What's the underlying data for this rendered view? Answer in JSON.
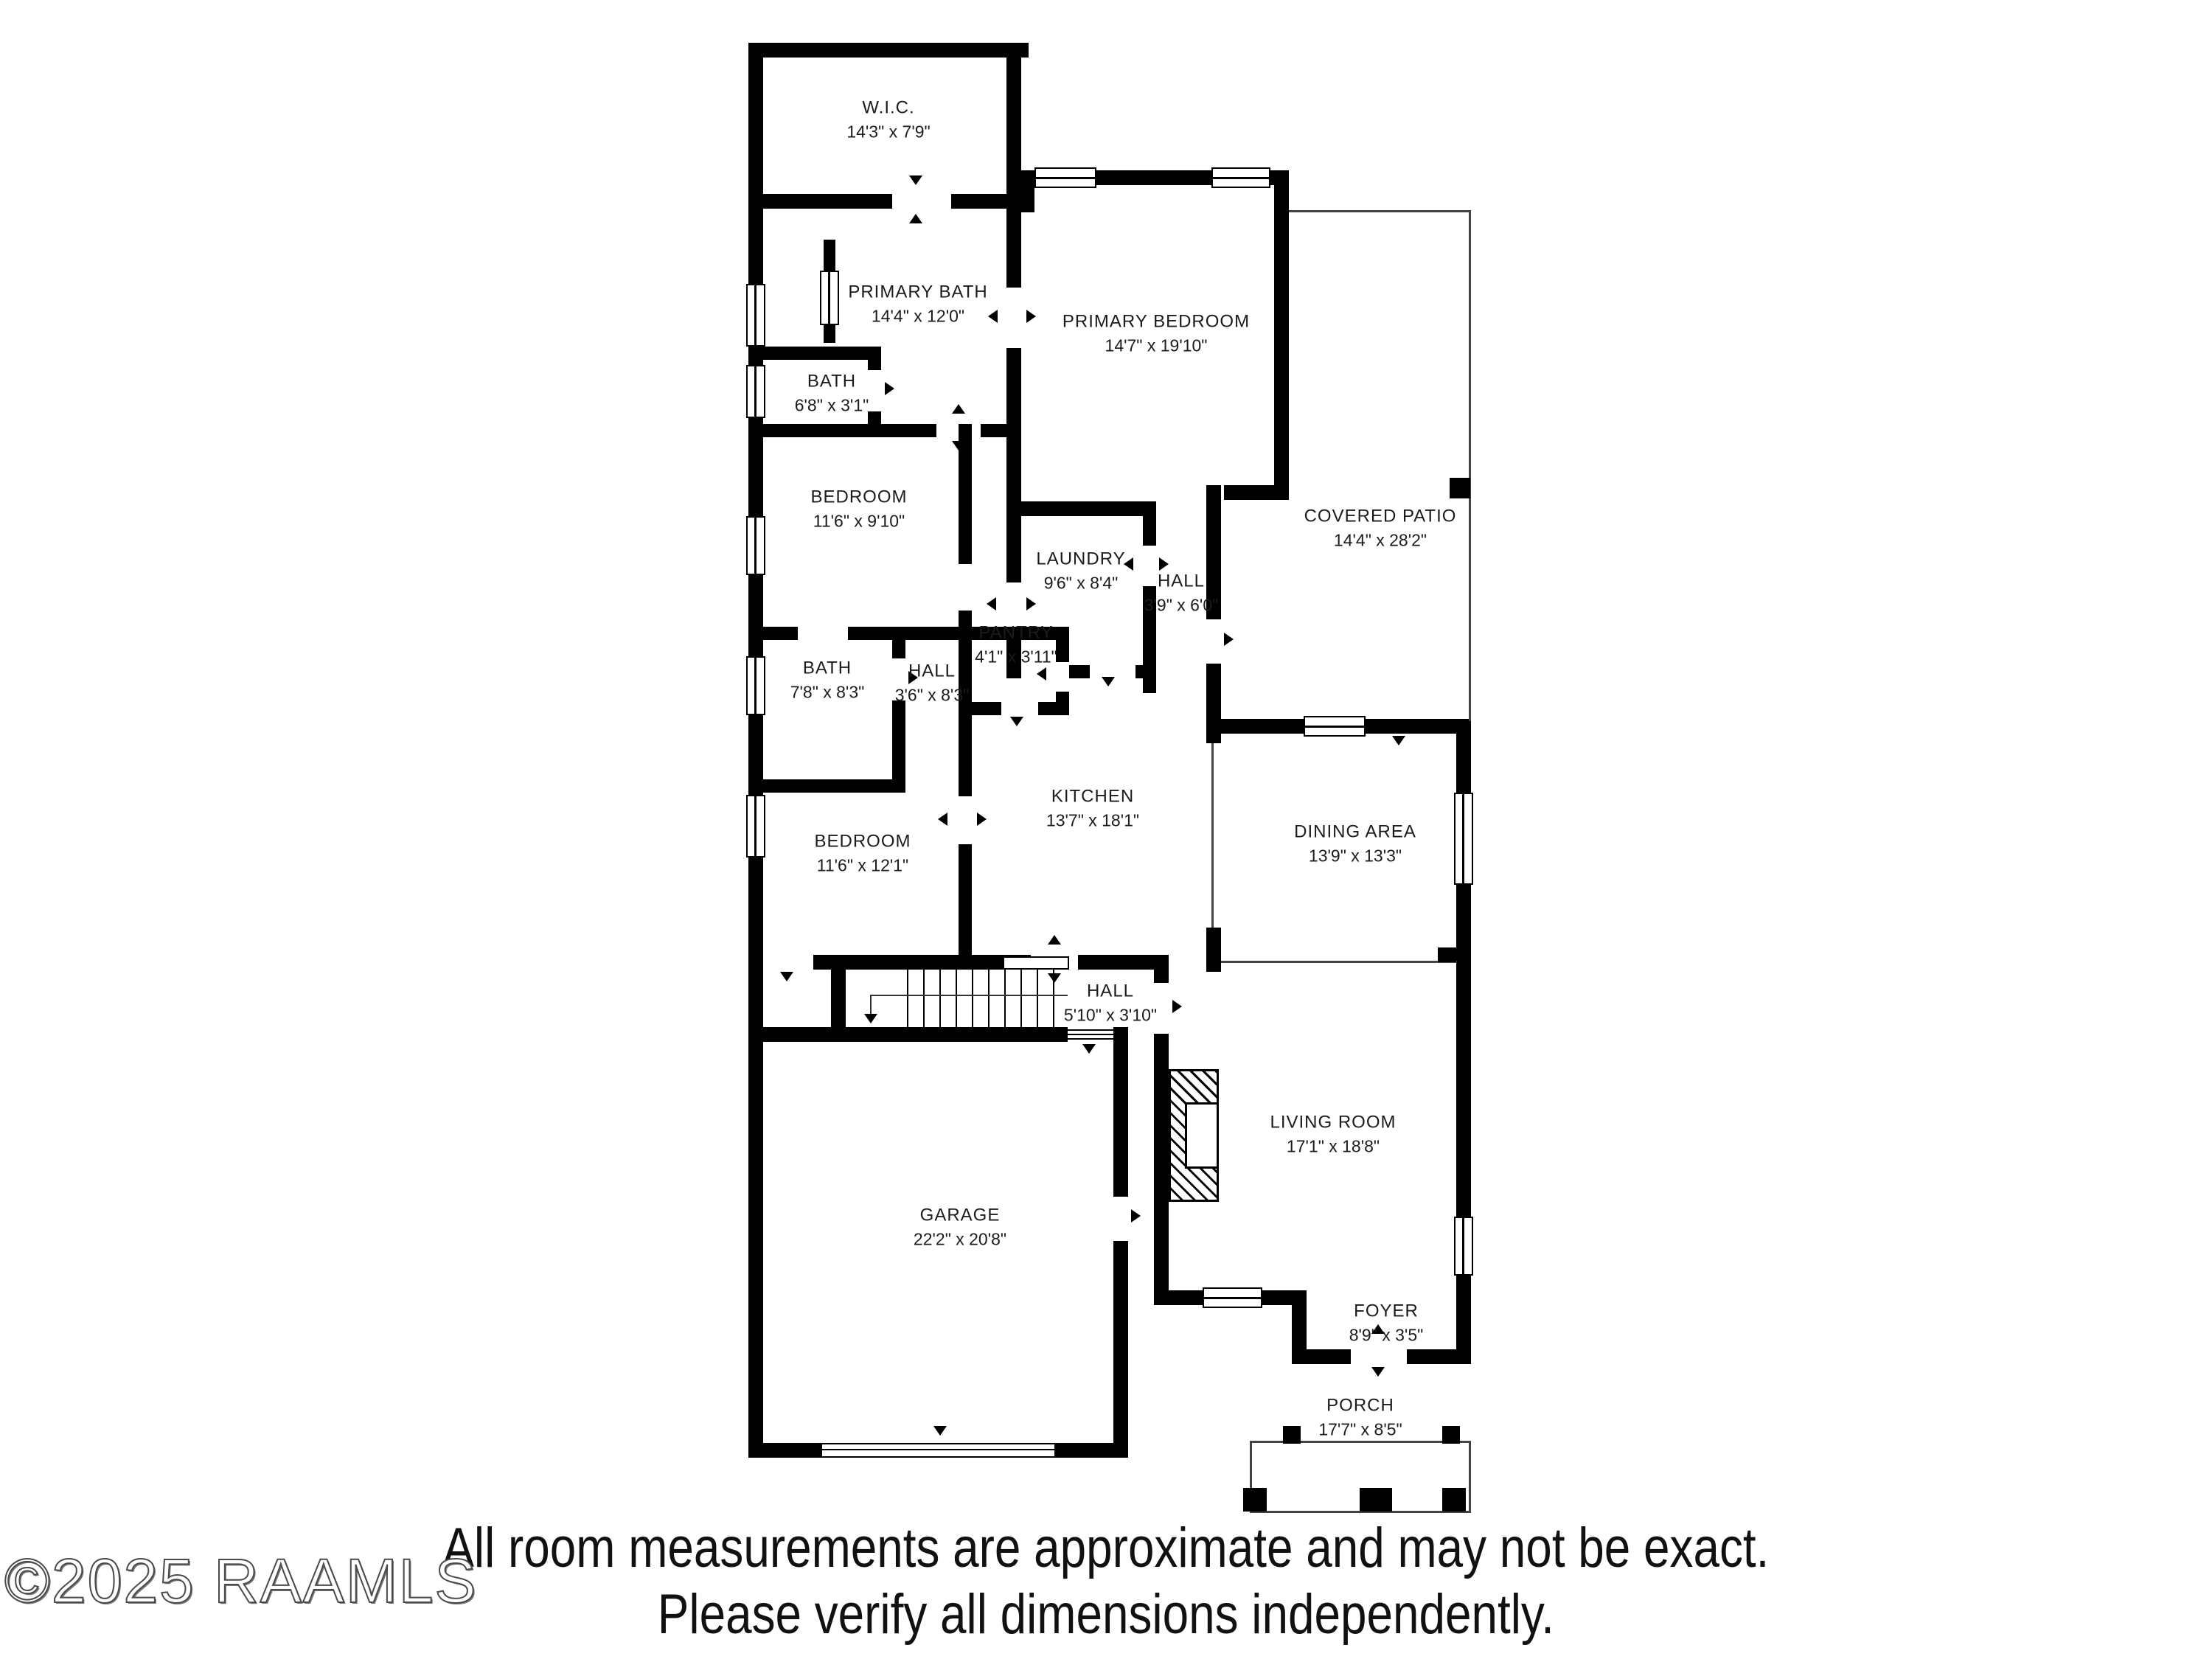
{
  "watermark": "©2025 RAAMLS",
  "disclaimer": {
    "line1": "All room measurements are approximate and may not be exact.",
    "line2": "Please verify all dimensions independently."
  },
  "colors": {
    "wall": "#000000",
    "text": "#1b1b1b",
    "background": "#ffffff"
  },
  "rooms": [
    {
      "name": "W.I.C.",
      "dims": "14'3\" x 7'9\""
    },
    {
      "name": "PRIMARY BATH",
      "dims": "14'4\" x 12'0\""
    },
    {
      "name": "BATH",
      "dims": "6'8\" x 3'1\""
    },
    {
      "name": "PRIMARY BEDROOM",
      "dims": "14'7\" x 19'10\""
    },
    {
      "name": "COVERED PATIO",
      "dims": "14'4\" x 28'2\""
    },
    {
      "name": "BEDROOM",
      "dims": "11'6\" x 9'10\""
    },
    {
      "name": "LAUNDRY",
      "dims": "9'6\" x 8'4\""
    },
    {
      "name": "HALL",
      "dims": "3'9\" x 6'0\""
    },
    {
      "name": "PANTRY",
      "dims": "4'1\" x 3'11\""
    },
    {
      "name": "BATH",
      "dims": "7'8\" x 8'3\""
    },
    {
      "name": "HALL",
      "dims": "3'6\" x 8'3\""
    },
    {
      "name": "KITCHEN",
      "dims": "13'7\" x 18'1\""
    },
    {
      "name": "DINING AREA",
      "dims": "13'9\" x 13'3\""
    },
    {
      "name": "BEDROOM",
      "dims": "11'6\" x 12'1\""
    },
    {
      "name": "HALL",
      "dims": "5'10\" x 3'10\""
    },
    {
      "name": "GARAGE",
      "dims": "22'2\" x 20'8\""
    },
    {
      "name": "LIVING ROOM",
      "dims": "17'1\" x 18'8\""
    },
    {
      "name": "FOYER",
      "dims": "8'9\" x 3'5\""
    },
    {
      "name": "PORCH",
      "dims": "17'7\" x 8'5\""
    }
  ]
}
